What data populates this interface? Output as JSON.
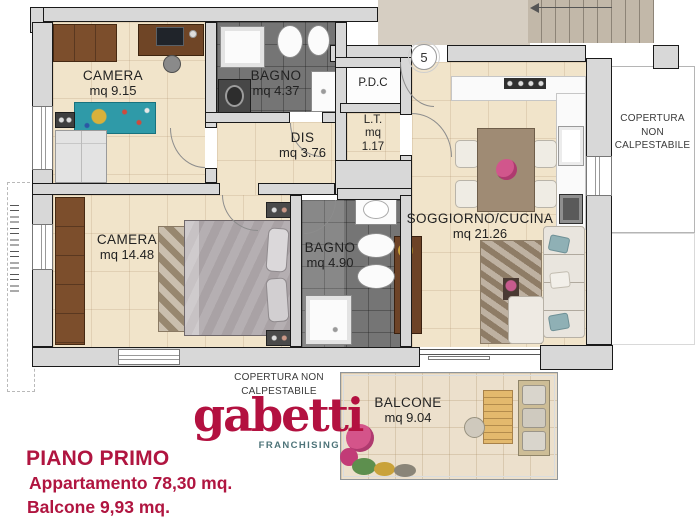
{
  "brand": {
    "accent_crimson": "#B01540",
    "franchising_teal": "#4E7479",
    "floor_beige": "#F1E4CA",
    "bath_gray": "#757575",
    "wall_gray": "#D8D8D8"
  },
  "plan": {
    "unit_number": "5",
    "rooms": {
      "camera1": {
        "name": "CAMERA",
        "area": "mq 9.15"
      },
      "bagno1": {
        "name": "BAGNO",
        "area": "mq 4.37"
      },
      "pdc": {
        "name": "P.D.C"
      },
      "lt": {
        "name": "L.T.",
        "line2": "mq",
        "line3": "1.17"
      },
      "dis": {
        "name": "DIS",
        "area": "mq 3.76"
      },
      "soggiorno": {
        "name": "SOGGIORNO/CUCINA",
        "area": "mq 21.26"
      },
      "camera2": {
        "name": "CAMERA",
        "area": "mq 14.48"
      },
      "bagno2": {
        "name": "BAGNO",
        "area": "mq 4.90"
      },
      "balcone": {
        "name": "BALCONE",
        "area": "mq 9.04"
      }
    },
    "annotations": {
      "copertura_right": {
        "line1": "COPERTURA",
        "line2": "NON",
        "line3": "CALPESTABILE"
      },
      "copertura_bottom": {
        "line1": "COPERTURA NON",
        "line2": "CALPESTABILE"
      }
    }
  },
  "footer": {
    "logo": "gabetti",
    "logo_sub": "FRANCHISING",
    "title": "PIANO PRIMO",
    "apartment_line": "Appartamento  78,30 mq.",
    "balcony_line": "Balcone  9,93 mq."
  }
}
